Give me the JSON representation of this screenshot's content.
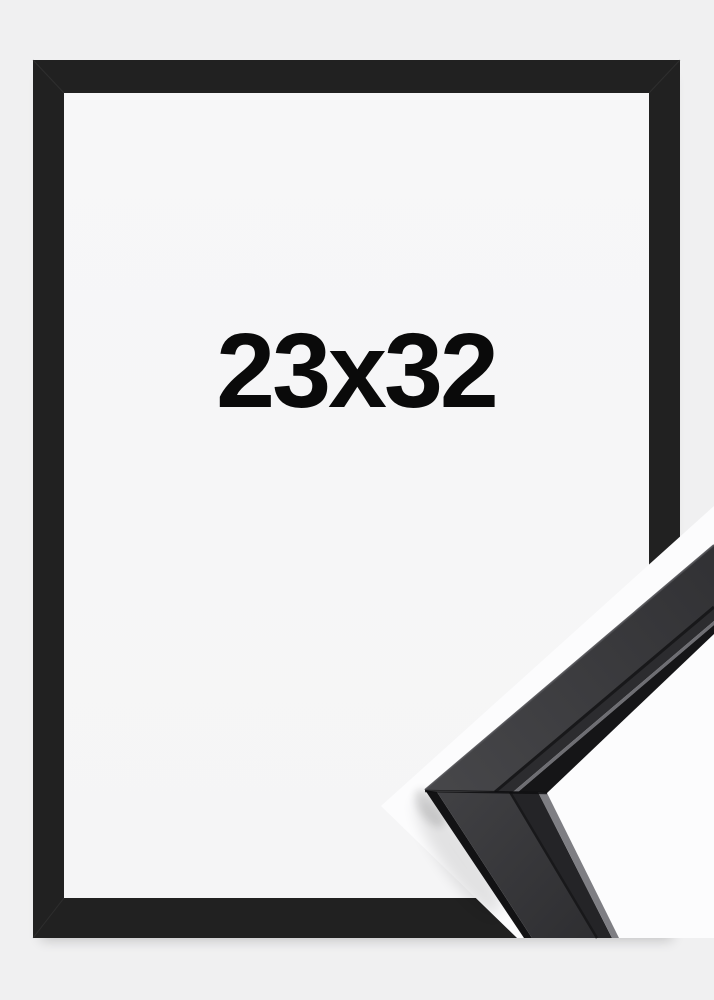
{
  "product": {
    "size_label": "23x32",
    "frame_style": "black",
    "colors": {
      "page-bg": "#f0f0f1",
      "frame-black": "#212121",
      "frame-inner-bg": "#f6f6f7",
      "detail-bg": "#fcfcfd",
      "label-text": "#0a0a0a",
      "moulding-top-face": "#3d3d40",
      "moulding-front-face": "#2c2c2f",
      "moulding-highlight": "#7e7e83"
    }
  }
}
